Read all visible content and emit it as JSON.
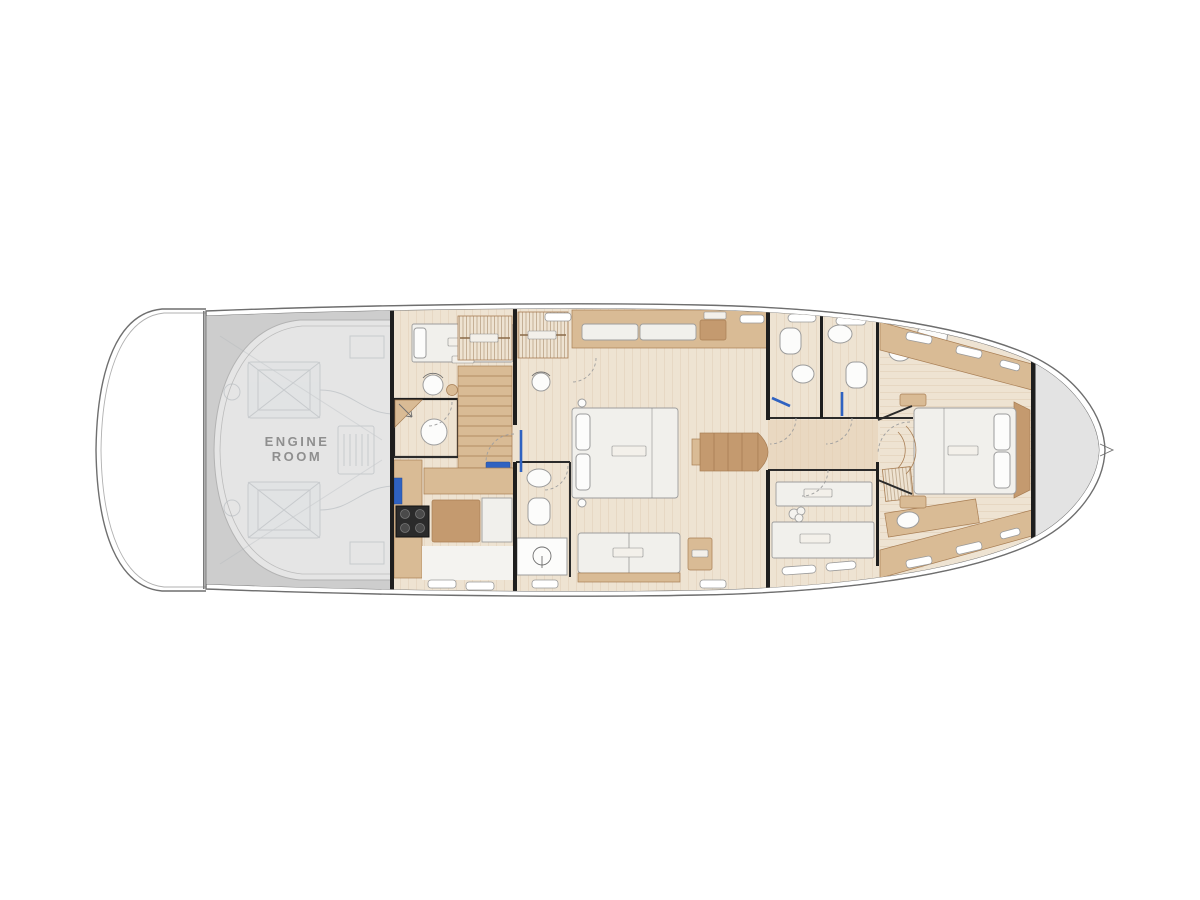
{
  "plan": {
    "engine_room_label": {
      "line1": "ENGINE",
      "line2": "ROOM"
    }
  },
  "colors": {
    "background": "#ffffff",
    "hull_stroke": "#6f6f6f",
    "engine_outer": "#cdcdcd",
    "engine_inner": "#e5e5e5",
    "engine_lines": "#aab1b6",
    "label_text": "#8f8f8f",
    "floor_light": "#eee3d2",
    "plank_line": "#cfb391",
    "wood_mid": "#d9bb95",
    "wood_dark": "#c49a6f",
    "wood_deep": "#a87e54",
    "white_furniture": "#f1f0ec",
    "furniture_stroke": "#9d9d9d",
    "bulkhead": "#1e1e1e",
    "accent_blue": "#2f62c1",
    "gray_area": "#e3e3e3"
  }
}
